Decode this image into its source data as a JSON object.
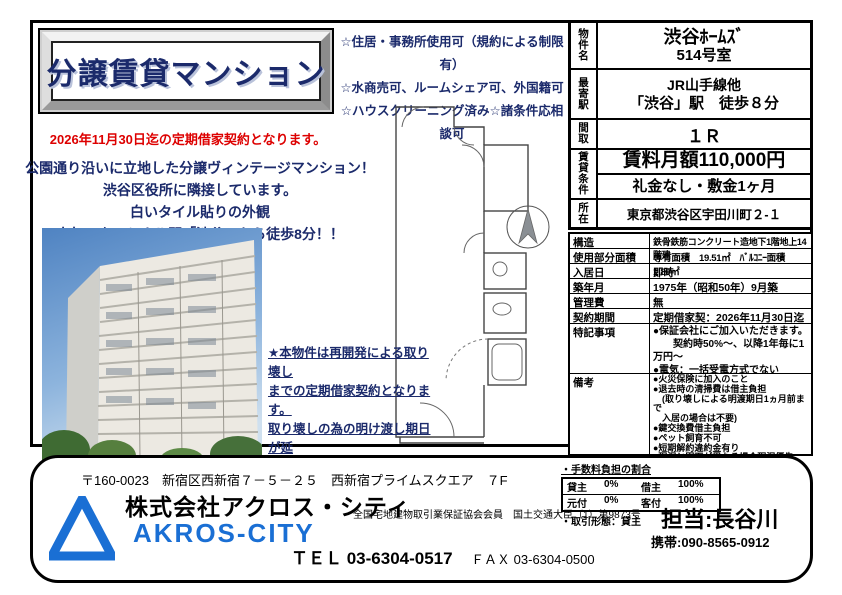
{
  "colors": {
    "navy": "#1b2a6b",
    "red": "#dd0000",
    "brand_blue": "#1a6fd4"
  },
  "title": "分譲賃貸マンション",
  "notice": "2026年11月30日迄の定期借家契約となります。",
  "features": [
    "☆住居・事務所使用可（規約による制限有）",
    "☆水商売可、ルームシェア可、外国籍可",
    "☆ハウスクリーニング済み☆諸条件応相談可"
  ],
  "description": [
    "公園通り沿いに立地した分譲ヴィンテージマンション！",
    "渋谷区役所に隣接しています。",
    "白いタイル貼りの外観",
    "人気のターミナル駅「渋谷」から徒歩8分！！"
  ],
  "note": [
    "★本物件は再開発による取り壊し",
    "までの定期借家契約となります。",
    "取り壊しの為の明け渡し期日が延",
    "期となった場合、新たな明け渡し",
    "期日まで再契約は可能です。"
  ],
  "property": {
    "name_label": "物件名",
    "name_line1": "渋谷ﾎｰﾑｽﾞ",
    "name_line2": "514号室",
    "station_label": "最寄駅",
    "station_line1": "JR山手線他",
    "station_line2": "「渋谷」駅　徒歩８分",
    "layout_label": "間取",
    "layout": "１Ｒ",
    "terms_label": "賃貸条件",
    "rent": "賃料月額110,000円",
    "terms": "礼金なし・敷金1ヶ月",
    "address_label": "所在",
    "address": "東京都渋谷区宇田川町２-１"
  },
  "details": {
    "rows": [
      {
        "label": "構造",
        "value": "鉄骨鉄筋コンクリート造地下1階地上14階建"
      },
      {
        "label": "使用部分面積",
        "value": "専有面積　19.51㎡　ﾊﾞﾙｺﾆｰ面積　1.80㎡"
      },
      {
        "label": "入居日",
        "value": "即時"
      },
      {
        "label": "築年月",
        "value": "1975年（昭和50年）9月築"
      },
      {
        "label": "管理費",
        "value": "無"
      },
      {
        "label": "契約期間",
        "value": "定期借家契：2026年11月30日迄"
      },
      {
        "label": "特記事項",
        "value": "●保証会社にご加入いただきます。\n　　契約時50%～、以降1年毎に1万円～\n●電気：一括受電方式でない"
      },
      {
        "label": "備考",
        "value": "●火災保険に加入のこと\n●退去時の清掃費は借主負担\n　(取り壊しによる明渡期日1ヵ月前まで\n　入居の場合は不要)\n●鍵交換費借主負担\n●ペット飼育不可\n●短期解約違約金有り\n●現況と図面が異なる場合現況優先"
      }
    ]
  },
  "footer": {
    "address": "〒160-0023　新宿区西新宿７－５－２５　西新宿プライムスクエア　７F",
    "company": "株式会社アクロス・シティ",
    "company_en": "AKROS-CITY",
    "registration": "全国宅地建物取引業保証協会会員　国土交通大臣（1）第9873号",
    "tel": "ＴＥＬ 03-6304-0517",
    "fax": "ＦＡＸ 03-6304-0500",
    "fee_title": "・手数料負担の割合",
    "fee_rows": [
      [
        "貸主",
        "0%",
        "借主",
        "100%"
      ],
      [
        "元付",
        "0%",
        "客付",
        "100%"
      ]
    ],
    "transaction": "・取引形態：貸主",
    "agent": "担当:長谷川",
    "mobile": "携帯:090-8565-0912"
  }
}
